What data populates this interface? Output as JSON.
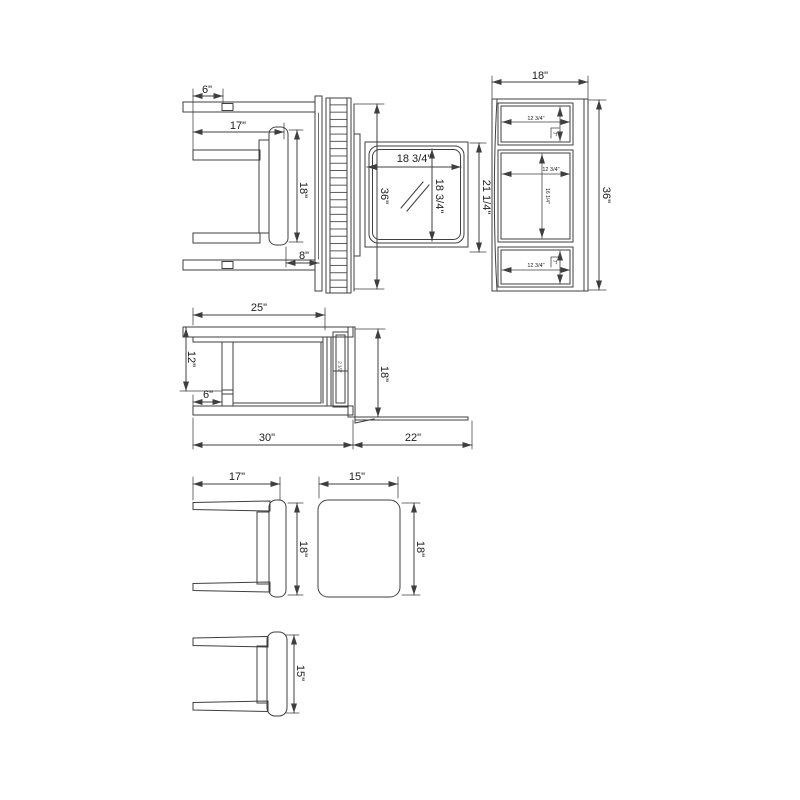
{
  "page": {
    "background": "#ffffff",
    "line_color": "#3f3f3f",
    "text_color": "#1c1c1c",
    "description": "vanity table, hutch mirror and stool dimension drawing"
  },
  "views": {
    "stool_plan": {
      "dim_leg_inset": "6\"",
      "dim_width": "17\"",
      "dim_seat_depth": "18\"",
      "dim_seat_offset": "8\""
    },
    "slatted_panel": {
      "dim_length": "36\""
    },
    "mirror": {
      "dim_glass_width": "18 3/4\"",
      "dim_glass_height": "18 3/4\"",
      "dim_overall_height": "21 1/4\""
    },
    "hutch": {
      "dim_width": "18\"",
      "dim_height": "36\"",
      "top_opening": {
        "w": "12 3/4\"",
        "h": "7\""
      },
      "middle_opening": {
        "w": "12 3/4\"",
        "h": "16 1/4\""
      },
      "bottom_opening": {
        "w": "12 3/4\"",
        "h": "7\""
      }
    },
    "desk_side": {
      "dim_top_width": "25\"",
      "dim_leg_height": "12\"",
      "dim_leg_inset": "6\"",
      "dim_depth": "18\"",
      "dim_rail": "2 1/2\"",
      "dim_base": "30\"",
      "dim_extension": "22\""
    },
    "stool_side": {
      "dim_width": "17\"",
      "dim_height": "18\""
    },
    "cushion": {
      "dim_width": "15\"",
      "dim_height": "18\""
    },
    "stool_front": {
      "dim_height": "15\""
    }
  }
}
